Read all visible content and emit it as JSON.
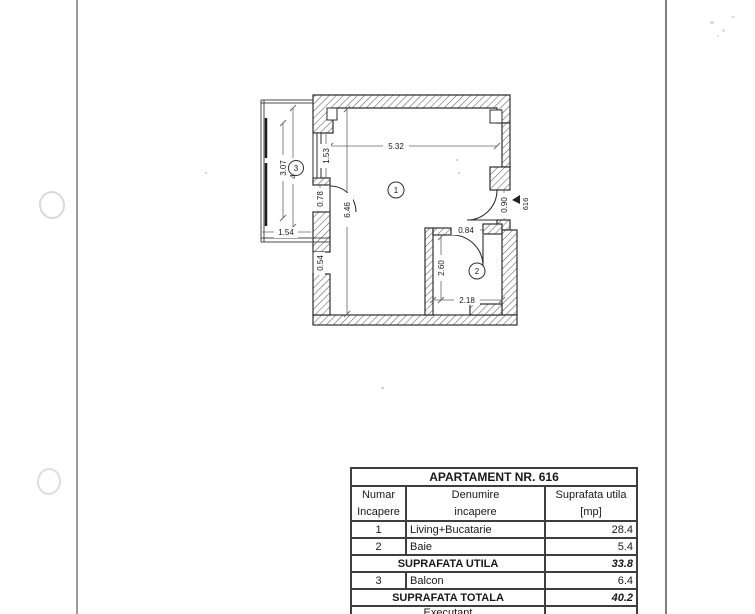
{
  "table": {
    "title": "APARTAMENT NR. 616",
    "col_numar_1": "Numar",
    "col_numar_2": "Incapere",
    "col_denumire_1": "Denumire",
    "col_denumire_2": "incapere",
    "col_suprafata_1": "Suprafata utila",
    "col_suprafata_2": "[mp]",
    "rows": [
      {
        "nr": "1",
        "name": "Living+Bucatarie",
        "area": "28.4"
      },
      {
        "nr": "2",
        "name": "Baie",
        "area": "5.4"
      },
      {
        "nr": "3",
        "name": "Balcon",
        "area": "6.4"
      }
    ],
    "subtotal_label": "SUPRAFATA UTILA",
    "subtotal_value": "33.8",
    "total_label": "SUPRAFATA TOTALA",
    "total_value": "40.2",
    "footer_label": "Executant"
  },
  "plan": {
    "room_labels": {
      "living": "1",
      "baie": "2",
      "balcon": "3"
    },
    "dims": {
      "living_width": "5.32",
      "living_height": "6.46",
      "window_left": "1.53",
      "door_balcony": "0.78",
      "window_small": "0.54",
      "balcony_inner": "3.07",
      "balcony_outer": "4.15",
      "balcony_width": "1.54",
      "door_entrance": "0.90",
      "apartment_no": "616",
      "door_bath": "0.84",
      "bath_height": "2.60",
      "bath_width": "2.18"
    }
  }
}
